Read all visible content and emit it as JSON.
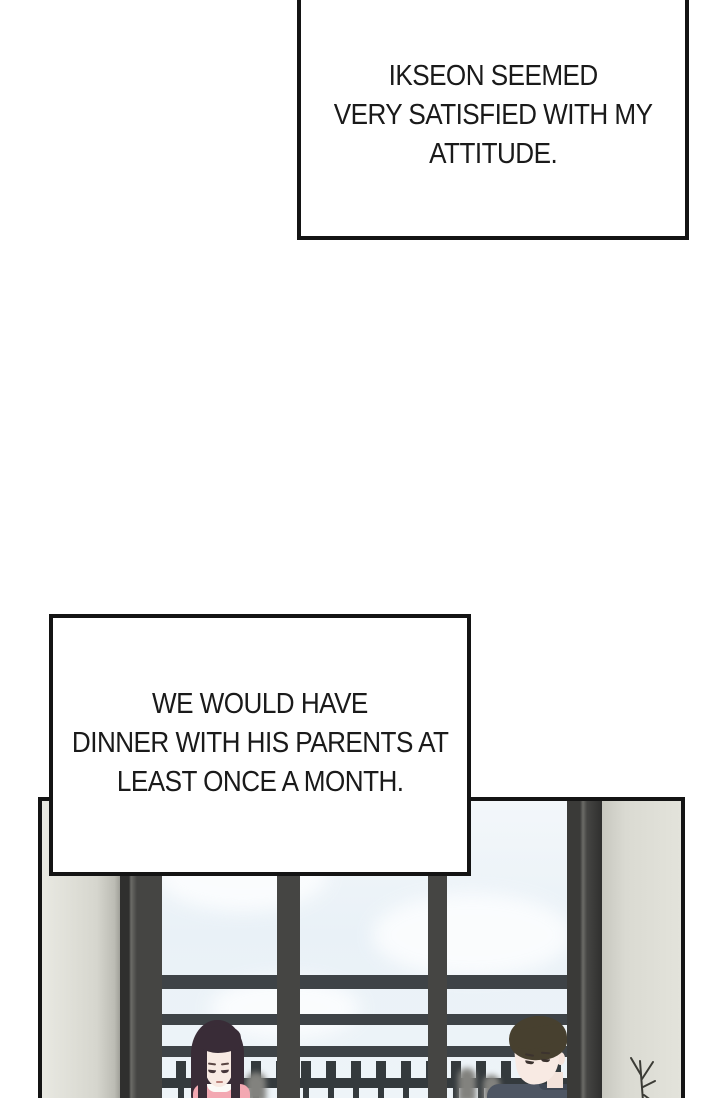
{
  "captions": {
    "top": {
      "lines": [
        "IKSEON SEEMED",
        "VERY SATISFIED WITH MY",
        "ATTITUDE."
      ]
    },
    "middle": {
      "lines": [
        "WE WOULD HAVE",
        "DINNER WITH HIS PARENTS AT",
        "LEAST ONCE A MONTH."
      ]
    }
  },
  "palette": {
    "ink": "#141414",
    "paper": "#ffffff",
    "wall": "#d6d6ce",
    "window_frame": "#454543",
    "sky": "#edf3f8",
    "railing": "#3e4347",
    "fence": "#343a3d",
    "woman_hair": "#392c37",
    "woman_top": "#f3a8b2",
    "man_hair": "#47402f",
    "man_top": "#4e5663",
    "skin": "#f8eae3"
  }
}
